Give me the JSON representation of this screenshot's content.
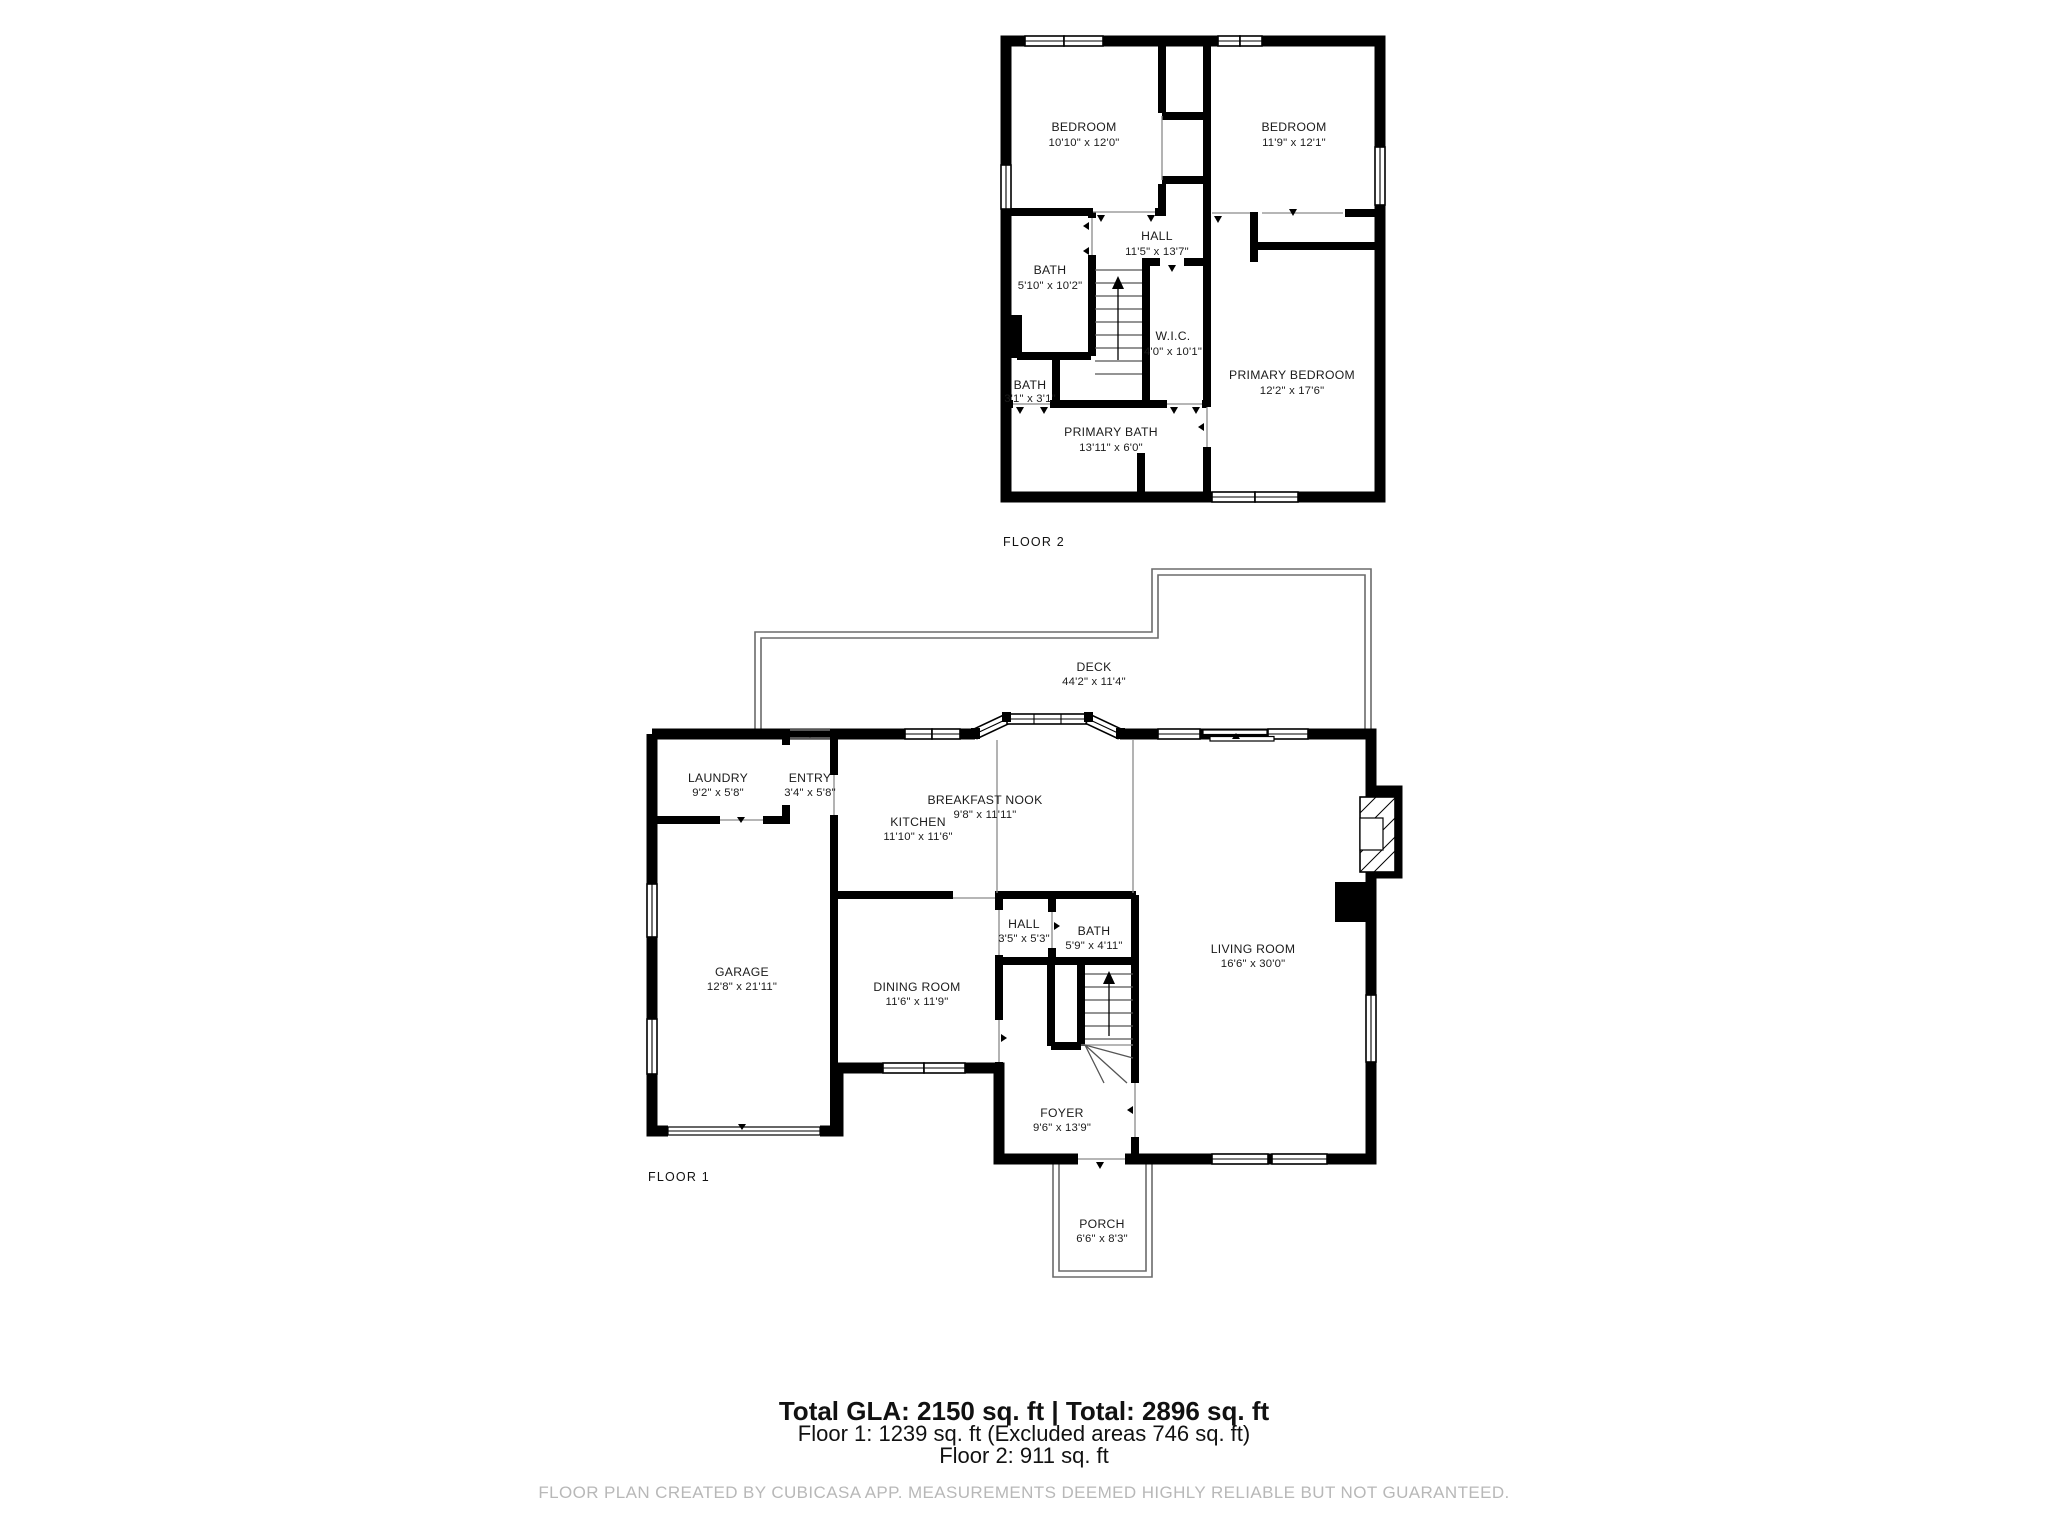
{
  "colors": {
    "wall": "#000000",
    "background": "#ffffff",
    "text": "#1b1b1b",
    "muted_text": "#b8b8b8",
    "thin_line": "#8a8a8a"
  },
  "floors": [
    {
      "label": "FLOOR 2",
      "rooms": [
        {
          "id": "bedroom-left",
          "name": "BEDROOM",
          "dims": "10'10\" x 12'0\""
        },
        {
          "id": "bedroom-right",
          "name": "BEDROOM",
          "dims": "11'9\" x 12'1\""
        },
        {
          "id": "hall",
          "name": "HALL",
          "dims": "11'5\" x 13'7\""
        },
        {
          "id": "bath",
          "name": "BATH",
          "dims": "5'10\" x 10'2\""
        },
        {
          "id": "wic",
          "name": "W.I.C.",
          "dims": "4'0\" x 10'1\""
        },
        {
          "id": "bath-small",
          "name": "BATH",
          "dims": "3'1\" x 3'1\""
        },
        {
          "id": "primary-bedroom",
          "name": "PRIMARY BEDROOM",
          "dims": "12'2\" x 17'6\""
        },
        {
          "id": "primary-bath",
          "name": "PRIMARY BATH",
          "dims": "13'11\" x 6'0\""
        }
      ]
    },
    {
      "label": "FLOOR 1",
      "rooms": [
        {
          "id": "deck",
          "name": "DECK",
          "dims": "44'2\" x 11'4\""
        },
        {
          "id": "laundry",
          "name": "LAUNDRY",
          "dims": "9'2\" x 5'8\""
        },
        {
          "id": "entry",
          "name": "ENTRY",
          "dims": "3'4\" x 5'8\""
        },
        {
          "id": "kitchen",
          "name": "KITCHEN",
          "dims": "11'10\" x 11'6\""
        },
        {
          "id": "breakfast-nook",
          "name": "BREAKFAST NOOK",
          "dims": "9'8\" x 11'11\""
        },
        {
          "id": "garage",
          "name": "GARAGE",
          "dims": "12'8\" x 21'11\""
        },
        {
          "id": "dining-room",
          "name": "DINING ROOM",
          "dims": "11'6\" x 11'9\""
        },
        {
          "id": "hall",
          "name": "HALL",
          "dims": "3'5\" x 5'3\""
        },
        {
          "id": "bath",
          "name": "BATH",
          "dims": "5'9\" x 4'11\""
        },
        {
          "id": "living-room",
          "name": "LIVING ROOM",
          "dims": "16'6\" x 30'0\""
        },
        {
          "id": "foyer",
          "name": "FOYER",
          "dims": "9'6\" x 13'9\""
        },
        {
          "id": "porch",
          "name": "PORCH",
          "dims": "6'6\" x 8'3\""
        }
      ]
    }
  ],
  "footer": {
    "totals": "Total GLA: 2150 sq. ft | Total: 2896 sq. ft",
    "floor1": "Floor 1: 1239 sq. ft (Excluded areas 746 sq. ft)",
    "floor2": "Floor 2: 911 sq. ft",
    "disclaimer": "FLOOR PLAN CREATED BY CUBICASA APP. MEASUREMENTS DEEMED HIGHLY RELIABLE BUT NOT GUARANTEED."
  }
}
